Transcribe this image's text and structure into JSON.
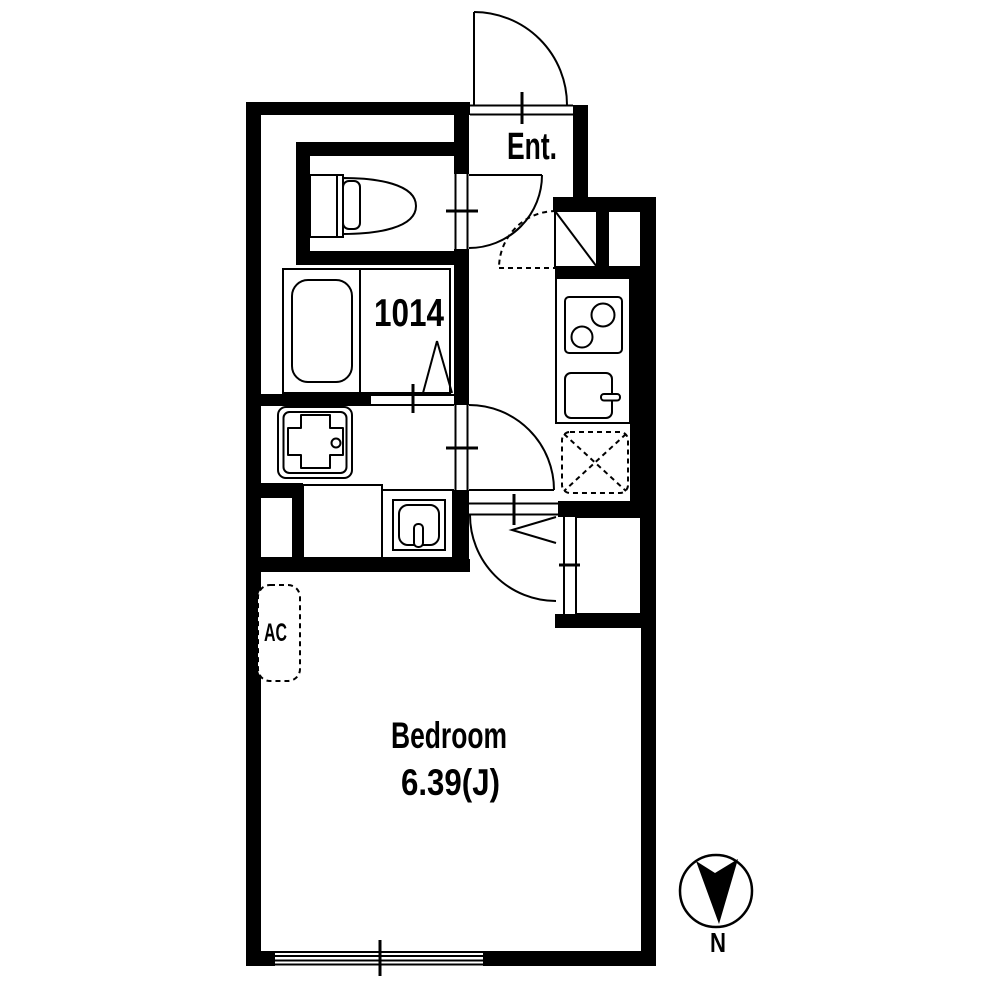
{
  "plan": {
    "entrance_label": "Ent.",
    "bath_unit_size": "1014",
    "bedroom": {
      "name": "Bedroom",
      "area": "6.39(J)"
    },
    "ac_label": "AC",
    "compass_label": "N"
  },
  "colors": {
    "wall": "#000000",
    "background": "#ffffff",
    "line": "#000000"
  },
  "icons": [
    "toilet-icon",
    "bathtub-icon",
    "washer-pan-icon",
    "vanity-sink-icon",
    "stove-icon",
    "kitchen-sink-icon",
    "fridge-space-icon",
    "shoe-box-icon",
    "door-swing-icon",
    "window-icon",
    "compass-north-icon",
    "ac-unit-icon"
  ]
}
